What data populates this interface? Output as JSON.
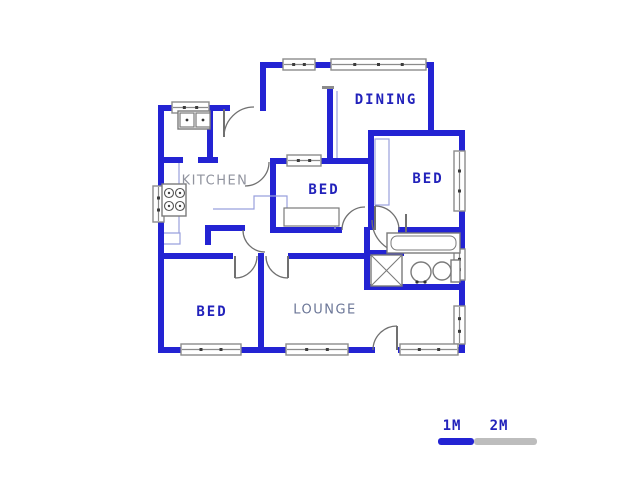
{
  "canvas": {
    "width": 640,
    "height": 480,
    "background": "#ffffff"
  },
  "colors": {
    "wall": "#2323d3",
    "window_frame": "#8b8b8b",
    "window_tick": "#3c3c3c",
    "door": "#707070",
    "counter": "#99a0dd",
    "fixture": "#7a7a7a",
    "label_navy": "#2222bb",
    "label_gray": "#90939e",
    "label_slate": "#6b7697",
    "scale_gray": "#bdbdbd"
  },
  "walls": [
    [
      158,
      105,
      6,
      248
    ],
    [
      158,
      105,
      72,
      6
    ],
    [
      260,
      62,
      6,
      49
    ],
    [
      260,
      62,
      174,
      6
    ],
    [
      428,
      62,
      6,
      74
    ],
    [
      368,
      130,
      97,
      6
    ],
    [
      459,
      130,
      6,
      223
    ],
    [
      158,
      347,
      217,
      6
    ],
    [
      398,
      347,
      67,
      6
    ],
    [
      368,
      130,
      6,
      100
    ],
    [
      270,
      158,
      100,
      6
    ],
    [
      270,
      158,
      6,
      75
    ],
    [
      270,
      227,
      72,
      6
    ],
    [
      327,
      88,
      6,
      76
    ],
    [
      207,
      105,
      6,
      58
    ],
    [
      158,
      157,
      25,
      6
    ],
    [
      198,
      157,
      20,
      6
    ],
    [
      205,
      225,
      40,
      6
    ],
    [
      205,
      225,
      6,
      20
    ],
    [
      158,
      253,
      75,
      6
    ],
    [
      258,
      253,
      6,
      100
    ],
    [
      288,
      253,
      82,
      6
    ],
    [
      364,
      227,
      6,
      63
    ],
    [
      364,
      250,
      40,
      6
    ],
    [
      364,
      284,
      101,
      6
    ],
    [
      398,
      227,
      67,
      6
    ]
  ],
  "wall_caps": [
    [
      322,
      86,
      12,
      3
    ]
  ],
  "windows": [
    {
      "x": 172,
      "y": 102,
      "w": 37,
      "h": 11,
      "horizontal": true
    },
    {
      "x": 283,
      "y": 59,
      "w": 32,
      "h": 11,
      "horizontal": true
    },
    {
      "x": 331,
      "y": 59,
      "w": 95,
      "h": 11,
      "horizontal": true
    },
    {
      "x": 153,
      "y": 186,
      "w": 11,
      "h": 36,
      "horizontal": false
    },
    {
      "x": 287,
      "y": 155,
      "w": 34,
      "h": 11,
      "horizontal": true
    },
    {
      "x": 454,
      "y": 151,
      "w": 11,
      "h": 60,
      "horizontal": false
    },
    {
      "x": 454,
      "y": 249,
      "w": 11,
      "h": 31,
      "horizontal": false
    },
    {
      "x": 454,
      "y": 306,
      "w": 11,
      "h": 38,
      "horizontal": false
    },
    {
      "x": 181,
      "y": 344,
      "w": 60,
      "h": 11,
      "horizontal": true
    },
    {
      "x": 286,
      "y": 344,
      "w": 62,
      "h": 11,
      "horizontal": true
    },
    {
      "x": 400,
      "y": 344,
      "w": 58,
      "h": 11,
      "horizontal": true
    }
  ],
  "doors": [
    {
      "d": "M 224,137 A 30,30 0 0 1 254,107",
      "leaf": "M 224,109 L 224,137"
    },
    {
      "d": "M 269,162 A 24,24 0 0 1 245,186",
      "leaf": ""
    },
    {
      "d": "M 243,230 A 22,22 0 0 0 265,252",
      "leaf": ""
    },
    {
      "d": "M 342,230 A 23,23 0 0 1 365,207",
      "leaf": ""
    },
    {
      "d": "M 375,206 A 24,24 0 0 1 399,230",
      "leaf": "M 375,206 L 375,230"
    },
    {
      "d": "M 372,220 A 33,33 0 0 0 405,253",
      "leaf": "M 406,214 L 406,232"
    },
    {
      "d": "M 235,278 A 22,22 0 0 0 257,256",
      "leaf": "M 235,256 L 235,278"
    },
    {
      "d": "M 266,256 A 22,22 0 0 0 288,278",
      "leaf": "M 288,256 L 288,278"
    },
    {
      "d": "M 373,350 A 24,24 0 0 1 397,326",
      "leaf": "M 397,326 L 397,350"
    }
  ],
  "counters": [
    "M 179,163 L 179,233",
    "M 164,233 L 180,233 L 180,244 L 164,244",
    "M 213,209 L 254,209 L 254,196 L 287,196 L 287,212 L 302,212 L 302,223 L 335,223 L 335,229",
    "M 337,91 L 337,158"
  ],
  "cupboards": [
    {
      "x": 375,
      "y": 139,
      "w": 14,
      "h": 66,
      "stroke": "counter"
    },
    {
      "x": 284,
      "y": 208,
      "w": 55,
      "h": 18,
      "stroke": "fixture"
    }
  ],
  "fixtures": {
    "sink": {
      "outer": [
        178,
        111,
        32,
        18
      ],
      "basins": [
        [
          180,
          113,
          14,
          14
        ],
        [
          196,
          113,
          14,
          14
        ]
      ]
    },
    "stove": {
      "outer": [
        162,
        184,
        24,
        32
      ],
      "burners": [
        [
          169,
          193
        ],
        [
          180,
          193
        ],
        [
          169,
          206
        ],
        [
          180,
          206
        ]
      ],
      "burner_r": 4.5
    },
    "bathtub": {
      "outer": [
        387,
        233,
        73,
        20
      ],
      "inner": [
        391,
        236,
        65,
        14
      ],
      "inner_rx": 6
    },
    "shower": {
      "rect": [
        371,
        255,
        31,
        31
      ]
    },
    "basin": {
      "cx": 421,
      "cy": 272,
      "r": 10,
      "taps": [
        [
          417,
          282
        ],
        [
          425,
          282
        ]
      ]
    },
    "toilet": {
      "bowl": [
        442,
        271,
        9
      ],
      "cistern": [
        451,
        260,
        9,
        22
      ]
    }
  },
  "labels": [
    {
      "text": "DINING",
      "x": 386,
      "y": 100,
      "cls": "lbl navy"
    },
    {
      "text": "BED",
      "x": 428,
      "y": 179,
      "cls": "lbl navy"
    },
    {
      "text": "BED",
      "x": 324,
      "y": 190,
      "cls": "lbl navy"
    },
    {
      "text": "BED",
      "x": 212,
      "y": 312,
      "cls": "lbl navy"
    },
    {
      "text": "KITCHEN",
      "x": 215,
      "y": 181,
      "cls": "lbl gray"
    },
    {
      "text": "LOUNGE",
      "x": 325,
      "y": 310,
      "cls": "lbl slate"
    }
  ],
  "scale": {
    "labels": [
      {
        "text": "1M",
        "x": 452,
        "y": 426
      },
      {
        "text": "2M",
        "x": 499,
        "y": 426
      }
    ],
    "blue_bar": {
      "x": 438,
      "y": 438,
      "w": 36,
      "h": 7
    },
    "gray_bar": {
      "x": 474,
      "y": 438,
      "w": 63,
      "h": 7
    }
  }
}
